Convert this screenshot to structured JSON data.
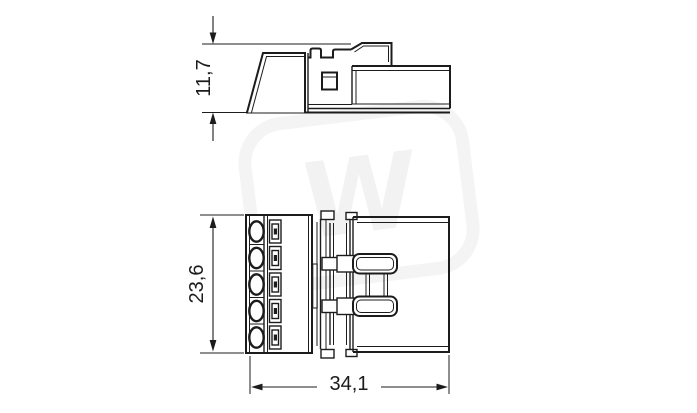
{
  "page": {
    "background_color": "#ffffff",
    "line_color": "#1c1c1c"
  },
  "views": {
    "side_view": {
      "height_label": "11,7"
    },
    "top_view": {
      "height_label": "23,6",
      "width_label": "34,1",
      "pole_count": 5
    }
  },
  "watermark": {
    "glyph": "W"
  }
}
